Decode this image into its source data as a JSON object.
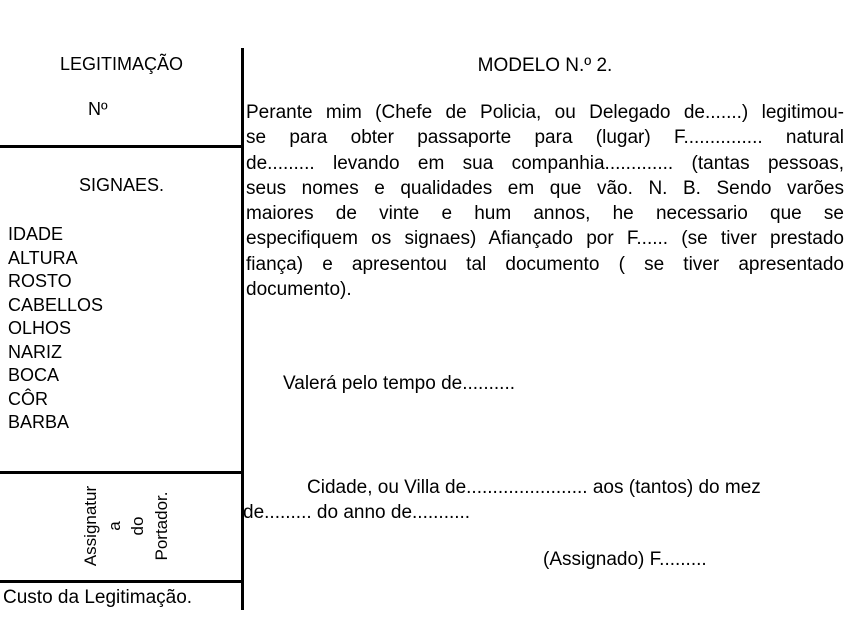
{
  "page": {
    "background": "#ffffff",
    "text_color": "#000000"
  },
  "left_panel": {
    "title": "LEGITIMAÇÃO",
    "number_label": "Nº",
    "signaes_heading": "SIGNAES.",
    "features": [
      "IDADE",
      "ALTURA",
      "ROSTO",
      "CABELLOS",
      "OLHOS",
      "NARIZ",
      "BOCA",
      "CÔR",
      "BARBA"
    ],
    "signature_rotated_lines": [
      "Assignatur",
      "a",
      "do",
      "Portador."
    ],
    "footer": "Custo da Legitimação."
  },
  "right_panel": {
    "heading": "MODELO N.º 2.",
    "paragraph_lines": [
      "Perante mim (Chefe de Policia, ou Delegado de.......) legitimou-",
      "se para obter passaporte para (lugar) F............... natural",
      "de......... levando em sua companhia............. (tantas pessoas,",
      "seus nomes e qualidades em que vão. N. B. Sendo varões",
      "maiores de vinte e hum annos, he necessario que se",
      "especifiquem os signaes) Afiançado por F...... (se tiver prestado",
      "fiança) e apresentou tal documento ( se tiver apresentado",
      "documento)."
    ],
    "validity_line": "Valerá pelo tempo de..........",
    "place_date_line1": "Cidade, ou Villa de....................... aos (tantos) do mez",
    "place_date_line2": "de......... do anno de...........",
    "signed_line": "(Assignado) F........."
  }
}
